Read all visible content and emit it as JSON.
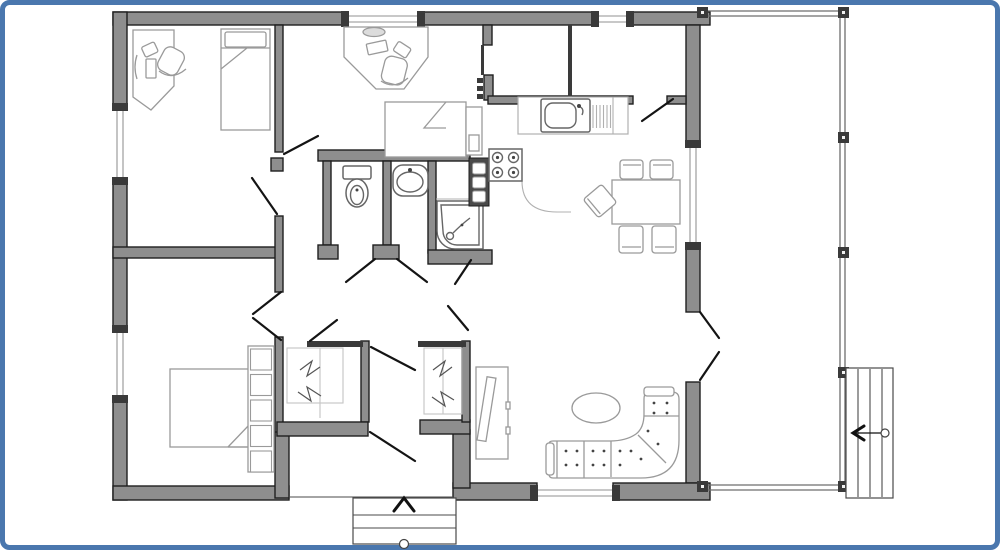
{
  "meta": {
    "type": "architectural-floor-plan",
    "description": "Black / grey line drawing of a single-storey house floor plan with furniture, attached right-side terrace with posts, side stairs and a front entry porch, framed by a blue rounded border. No text labels are rendered in the image."
  },
  "frame": {
    "color": "#4a77ae",
    "thickness": 5,
    "radius": 7,
    "inset": 3
  },
  "palette": {
    "wall_fill": "#8e8e8e",
    "wall_stroke": "#1f1f1f",
    "thin_fill": "#3a3a3a",
    "door": "#141414",
    "window_line": "#b5b5b5",
    "window_cap": "#3a3a3a",
    "rail": "#6e6e6e",
    "post": "#3a3a3a",
    "background": "#ffffff"
  },
  "plan": {
    "walls": [
      [
        113,
        12,
        235,
        13
      ],
      [
        418,
        12,
        180,
        13
      ],
      [
        627,
        12,
        83,
        13
      ],
      [
        113,
        12,
        14,
        98
      ],
      [
        113,
        178,
        14,
        154
      ],
      [
        113,
        396,
        14,
        104
      ],
      [
        686,
        25,
        14,
        122
      ],
      [
        686,
        243,
        14,
        69
      ],
      [
        686,
        382,
        14,
        101
      ],
      [
        613,
        483,
        97,
        17
      ],
      [
        453,
        483,
        84,
        17
      ],
      [
        453,
        430,
        17,
        58
      ],
      [
        113,
        486,
        176,
        14
      ],
      [
        275,
        430,
        14,
        68
      ],
      [
        275,
        25,
        8,
        127
      ],
      [
        271,
        158,
        12,
        13
      ],
      [
        113,
        247,
        164,
        11
      ],
      [
        275,
        216,
        8,
        76
      ],
      [
        275,
        337,
        8,
        95
      ],
      [
        318,
        150,
        152,
        11
      ],
      [
        323,
        161,
        8,
        84
      ],
      [
        318,
        245,
        20,
        14
      ],
      [
        383,
        161,
        8,
        84
      ],
      [
        373,
        245,
        26,
        14
      ],
      [
        428,
        161,
        8,
        92
      ],
      [
        428,
        250,
        64,
        14
      ],
      [
        483,
        25,
        9,
        20
      ],
      [
        484,
        75,
        9,
        25
      ],
      [
        488,
        96,
        145,
        8
      ],
      [
        667,
        96,
        19,
        8
      ],
      [
        361,
        341,
        8,
        81
      ],
      [
        277,
        422,
        91,
        14
      ],
      [
        420,
        420,
        50,
        14
      ],
      [
        462,
        341,
        8,
        81
      ]
    ],
    "thin_walls": [
      [
        307,
        341,
        56,
        6
      ],
      [
        418,
        341,
        48,
        6
      ],
      [
        568,
        25,
        4,
        73
      ],
      [
        481,
        45,
        3,
        30
      ]
    ],
    "windows": [
      {
        "o": "v",
        "x": 113,
        "y": 110,
        "len": 68
      },
      {
        "o": "v",
        "x": 113,
        "y": 332,
        "len": 64
      },
      {
        "o": "v",
        "x": 686,
        "y": 147,
        "len": 96
      },
      {
        "o": "h",
        "x": 348,
        "y": 12,
        "len": 70
      },
      {
        "o": "h",
        "x": 598,
        "y": 12,
        "len": 29
      },
      {
        "o": "h",
        "x": 537,
        "y": 486,
        "len": 76
      }
    ],
    "door_swings": [
      [
        277,
        214,
        252,
        178
      ],
      [
        284,
        154,
        318,
        136
      ],
      [
        281,
        292,
        253,
        314
      ],
      [
        253,
        318,
        281,
        340
      ],
      [
        375,
        259,
        346,
        282
      ],
      [
        397,
        259,
        427,
        282
      ],
      [
        471,
        260,
        455,
        284
      ],
      [
        310,
        341,
        337,
        320
      ],
      [
        448,
        306,
        468,
        330
      ],
      [
        371,
        347,
        415,
        370
      ],
      [
        370,
        432,
        415,
        461
      ],
      [
        642,
        121,
        673,
        99
      ],
      [
        700,
        312,
        719,
        338
      ],
      [
        719,
        352,
        700,
        380
      ]
    ],
    "hinge_ticks": [
      [
        477,
        78
      ],
      [
        477,
        86
      ],
      [
        477,
        94
      ]
    ],
    "terrace": {
      "rails": [
        [
          703,
          11,
          846,
          11
        ],
        [
          703,
          16,
          846,
          16
        ],
        [
          840,
          16,
          840,
          485
        ],
        [
          845,
          16,
          845,
          485
        ],
        [
          703,
          485,
          846,
          485
        ],
        [
          703,
          490,
          846,
          490
        ]
      ],
      "posts": [
        [
          697,
          7
        ],
        [
          838,
          7
        ],
        [
          838,
          132
        ],
        [
          838,
          247
        ],
        [
          838,
          367
        ],
        [
          838,
          481
        ],
        [
          697,
          481
        ]
      ],
      "post_size": 11
    },
    "side_stairs": {
      "x": 846,
      "y": 368,
      "w": 47,
      "h": 130,
      "treads": [
        858,
        870,
        882
      ],
      "arrow": [
        884,
        433,
        855,
        433
      ],
      "arrow_head": [
        [
          864,
          426
        ],
        [
          853,
          433
        ],
        [
          864,
          440
        ]
      ],
      "knob": [
        885,
        433,
        4
      ]
    },
    "porch": {
      "x": 353,
      "y": 498,
      "w": 103,
      "h": 46,
      "step_lines": [
        515,
        528
      ],
      "chevron": [
        [
          394,
          511
        ],
        [
          404,
          498
        ],
        [
          414,
          511
        ]
      ],
      "knob": [
        404,
        544,
        4.5
      ],
      "threshold": [
        289,
        497,
        453,
        497
      ]
    }
  },
  "furniture_inventory": [
    "corner-office-desk-with-chair",
    "single-bed-vertical",
    "angled-desk-with-chair",
    "single-bed-horizontal-with-side-unit",
    "toilet",
    "washbasin",
    "corner-shower",
    "tall-dark-cabinet",
    "kitchen-counter-with-sink-and-drainer",
    "stove-four-burners",
    "dining-table-with-five-chairs",
    "double-bed-with-shelf-column",
    "wardrobe-closet-left",
    "wardrobe-closet-right",
    "tv-cabinet",
    "oval-coffee-table",
    "tufted-corner-sofa",
    "terrace-posts",
    "side-stairs-with-arrow",
    "entry-porch-steps-with-arrow"
  ]
}
